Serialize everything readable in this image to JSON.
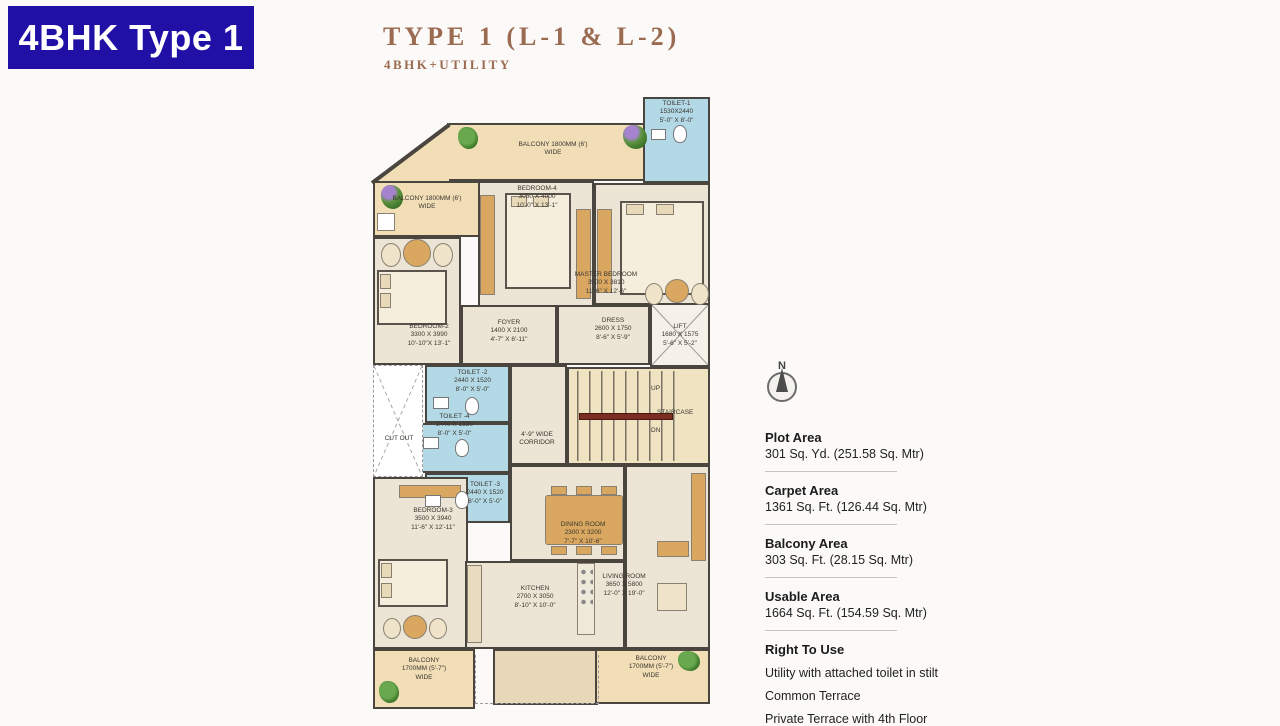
{
  "badge": {
    "label": "4BHK Type 1"
  },
  "header": {
    "title": "TYPE 1 (L-1 & L-2)",
    "subtitle": "4BHK+UTILITY"
  },
  "compass": {
    "north_label": "N"
  },
  "plan": {
    "rooms": {
      "toilet1": {
        "name": "TOILET-1",
        "mm": "1530X2440",
        "ft": "5'-0\" X 8'-0\""
      },
      "balcony_top": {
        "name": "BALCONY 1800MM (6')",
        "wide": "WIDE"
      },
      "balcony_left": {
        "name": "BALCONY 1800MM (6')",
        "wide": "WIDE"
      },
      "bedroom4": {
        "name": "BEDROOM-4",
        "mm": "3050 X 4000",
        "ft": "10'-0\" X 13'-1\""
      },
      "master": {
        "name": "MASTER BEDROOM",
        "mm": "3500 X 3810",
        "ft": "11'-6\" X 12'-6\""
      },
      "bedroom2": {
        "name": "BEDROOM-2",
        "mm": "3300 X 3990",
        "ft": "10'-10\"X 13'-1\""
      },
      "foyer": {
        "name": "FOYER",
        "mm": "1400 X 2100",
        "ft": "4'-7\" X 6'-11\""
      },
      "dress": {
        "name": "DRESS",
        "mm": "2600 X 1750",
        "ft": "8'-6\" X 5'-9\""
      },
      "lift": {
        "name": "LIFT",
        "mm": "1680 X 1575",
        "ft": "5'-6\" X 5'-2\""
      },
      "toilet2": {
        "name": "TOILET -2",
        "mm": "2440 X 1520",
        "ft": "8'-0\" X 5'-0\""
      },
      "toilet4": {
        "name": "TOILET -4",
        "mm": "2440 X 1520",
        "ft": "8'-0\" X 5'-0\""
      },
      "toilet3": {
        "name": "TOILET -3",
        "mm": "2440 X 1520",
        "ft": "8'-0\" X 5'-0\""
      },
      "cutout": {
        "name": "CUT OUT"
      },
      "corridor": {
        "line1": "4'-9\" WIDE",
        "line2": "CORRIDOR"
      },
      "stair": {
        "up": "UP",
        "label": "STAIRCASE",
        "dn": "DN"
      },
      "bedroom3": {
        "name": "BEDROOM-3",
        "mm": "3500 X 3940",
        "ft": "11'-6\" X 12'-11\""
      },
      "dining": {
        "name": "DINING ROOM",
        "mm": "2300 X 3200",
        "ft": "7'-7\" X 10'-6\""
      },
      "kitchen": {
        "name": "KITCHEN",
        "mm": "2700 X 3050",
        "ft": "8'-10\" X 10'-0\""
      },
      "living": {
        "name": "LIVING ROOM",
        "mm": "3650 X 5800",
        "ft": "12'-0\" X 19'-0\""
      },
      "balcony_bl": {
        "name": "BALCONY",
        "mm": "1700MM (5'-7\")",
        "wide": "WIDE"
      },
      "balcony_br": {
        "name": "BALCONY",
        "mm": "1700MM (5'-7\")",
        "wide": "WIDE"
      }
    }
  },
  "areas": [
    {
      "label": "Plot Area",
      "value": "301 Sq. Yd. (251.58 Sq. Mtr)"
    },
    {
      "label": "Carpet Area",
      "value": "1361 Sq. Ft. (126.44 Sq. Mtr)"
    },
    {
      "label": "Balcony Area",
      "value": "303 Sq. Ft. (28.15 Sq. Mtr)"
    },
    {
      "label": "Usable Area",
      "value": "1664 Sq. Ft. (154.59 Sq. Mtr)"
    }
  ],
  "right_to_use": {
    "label": "Right To Use",
    "items": [
      "Utility with attached toilet in stilt",
      "Common Terrace",
      "Private Terrace with 4th Floor"
    ]
  },
  "colors": {
    "badge_blue": "#2110a5",
    "title_brown": "#9b6b51",
    "wall": "#4a453f",
    "balcony_tan": "#f1ddb6",
    "room_cream": "#ece4d4",
    "toilet_blue": "#b3d9e6",
    "furniture_tan": "#d9a75f",
    "stair_rail_red": "#7b2d22"
  }
}
